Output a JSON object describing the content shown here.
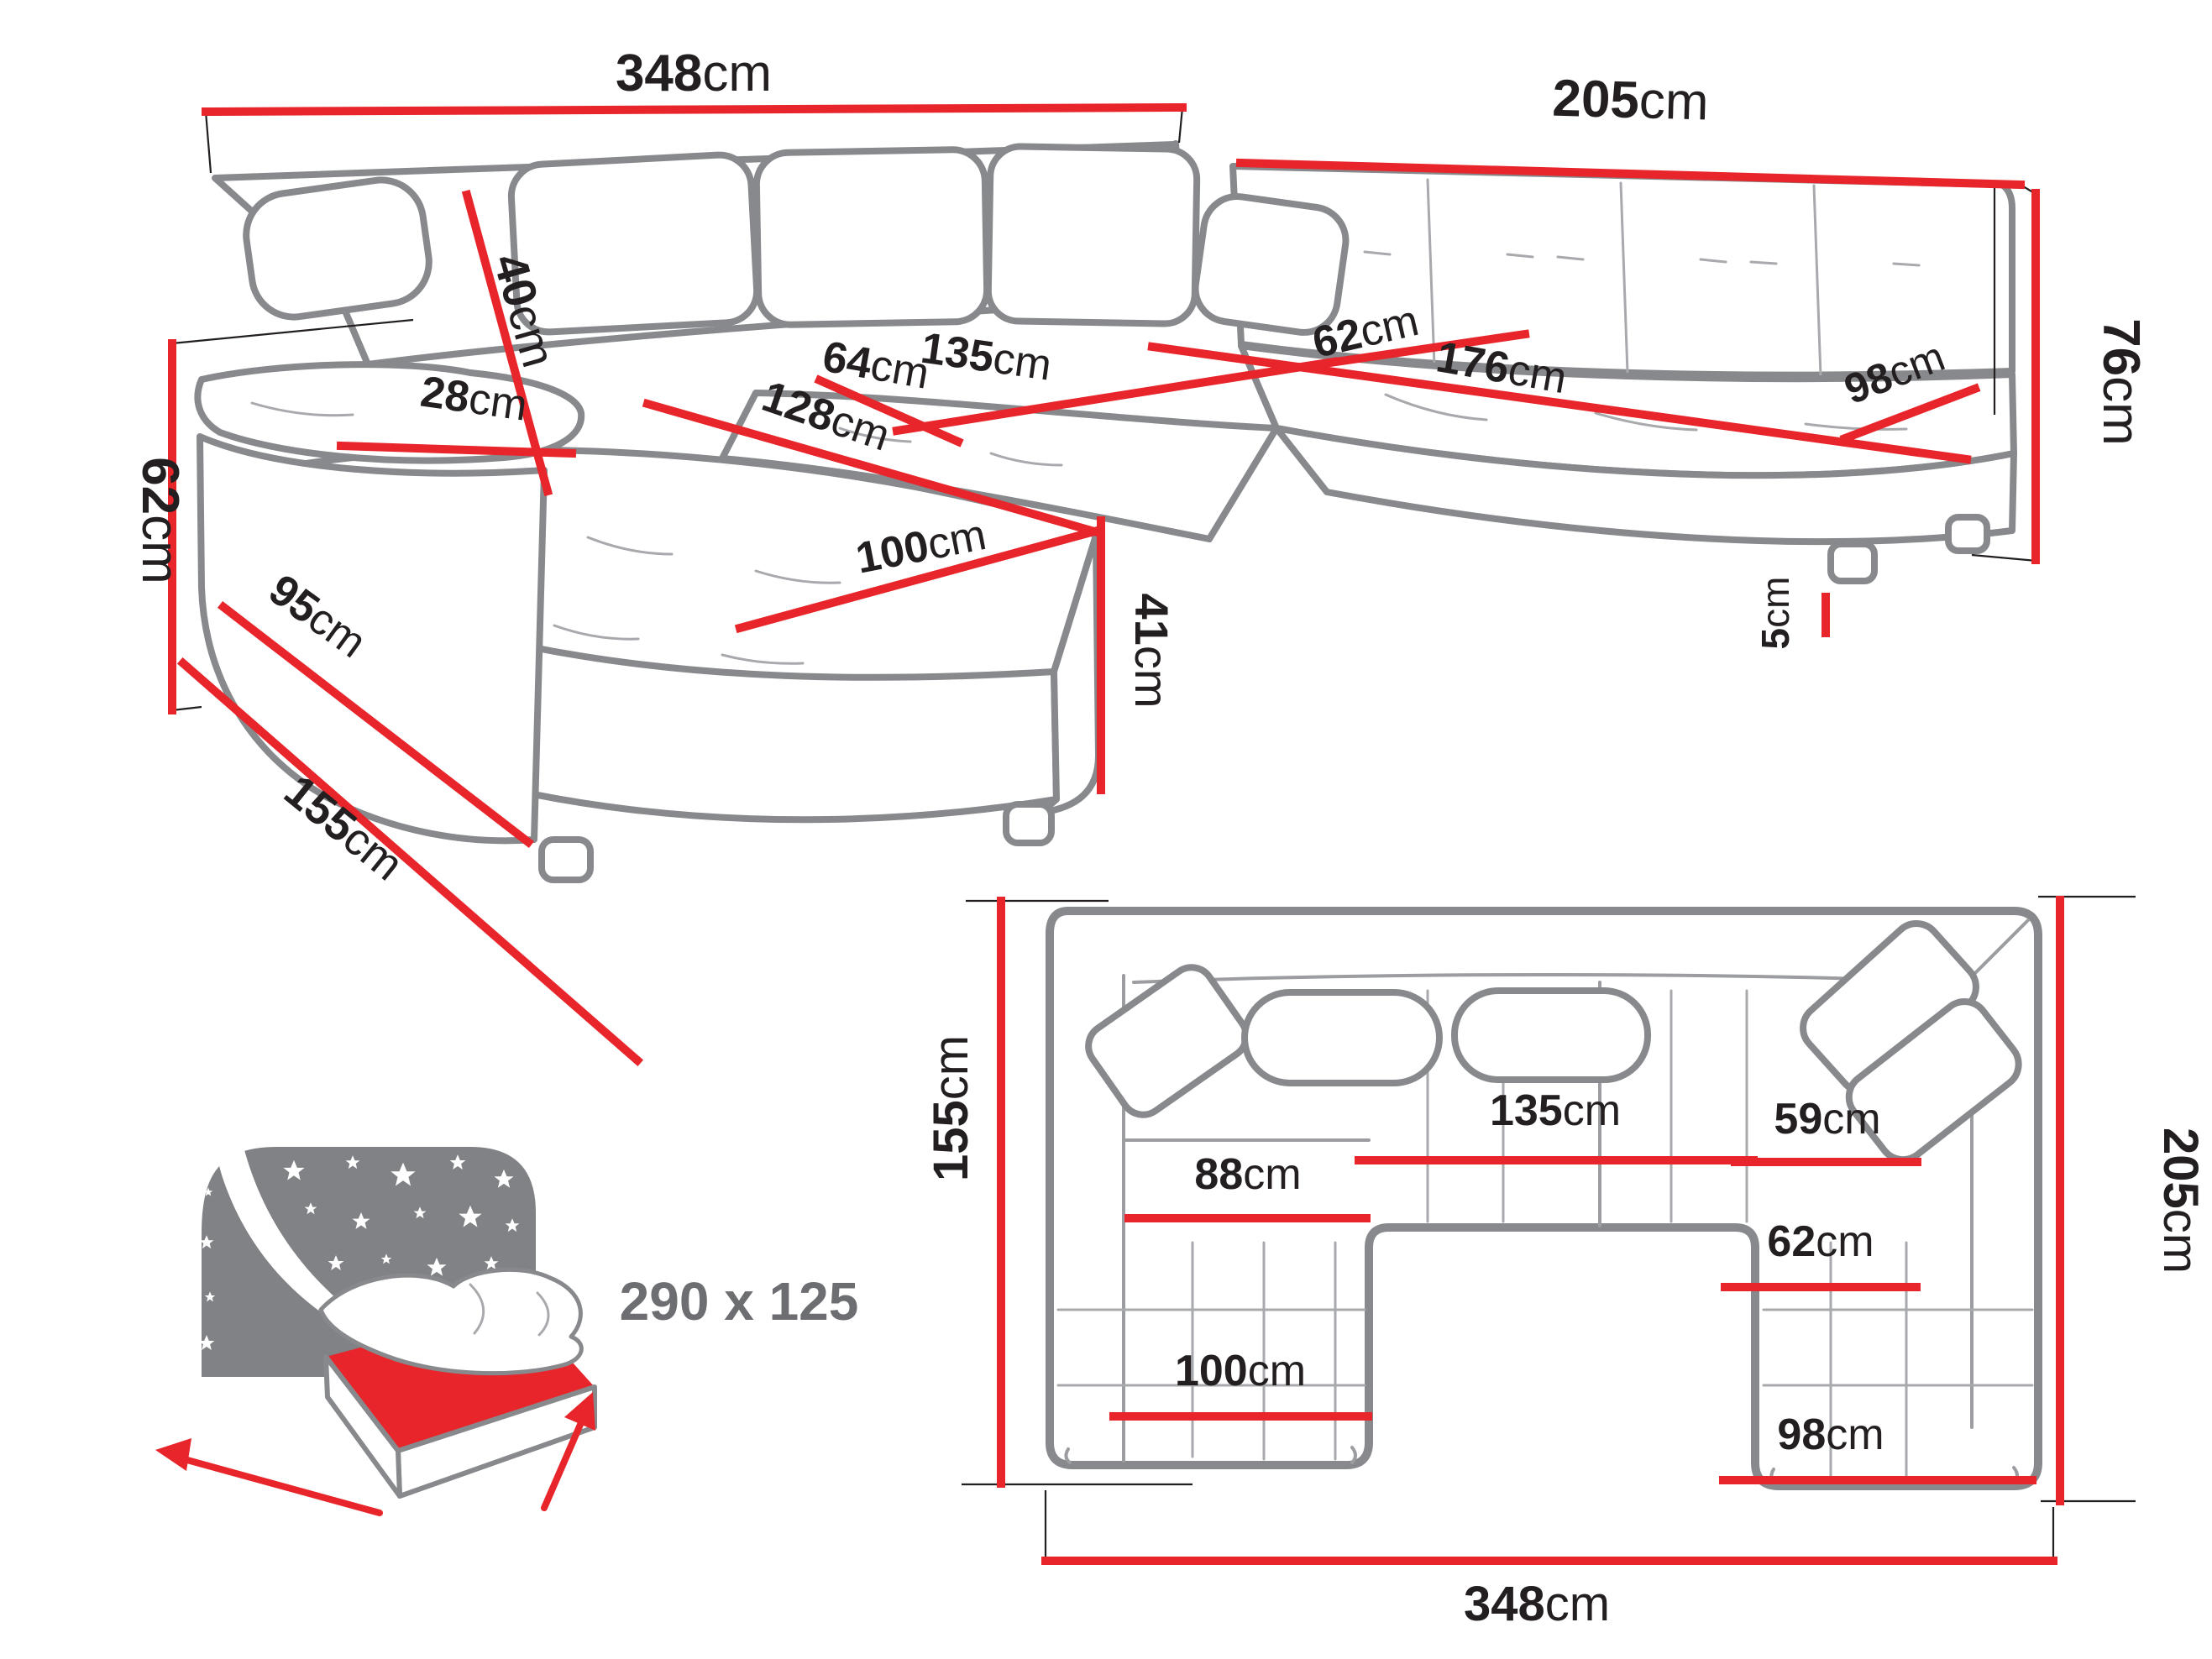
{
  "colors": {
    "accent_red": "#e8252a",
    "line_gray": "#87898c",
    "text_dark": "#231f20",
    "icon_gray": "#808285",
    "sleep_label_gray": "#6d6e71"
  },
  "perspective_view": {
    "dimensions": {
      "width_total": {
        "v": "348",
        "u": "cm"
      },
      "width_right": {
        "v": "205",
        "u": "cm"
      },
      "height_total": {
        "v": "76",
        "u": "cm"
      },
      "side_height": {
        "v": "62",
        "u": "cm"
      },
      "armrest_width": {
        "v": "28",
        "u": "cm"
      },
      "armrest_length": {
        "v": "95",
        "u": "cm"
      },
      "backrest_cushion": {
        "v": "40",
        "u": "cm"
      },
      "seat_depth": {
        "v": "64",
        "u": "cm"
      },
      "seat_width_center": {
        "v": "135",
        "u": "cm"
      },
      "chaise_length": {
        "v": "128",
        "u": "cm"
      },
      "chaise_width": {
        "v": "100",
        "u": "cm"
      },
      "seat_height": {
        "v": "41",
        "u": "cm"
      },
      "seat_depth_right": {
        "v": "62",
        "u": "cm"
      },
      "seat_width_right": {
        "v": "176",
        "u": "cm"
      },
      "seat_width_end": {
        "v": "98",
        "u": "cm"
      },
      "leg_height": {
        "v": "5",
        "u": "cm"
      },
      "chaise_depth": {
        "v": "155",
        "u": "cm"
      }
    }
  },
  "plan_view": {
    "dimensions": {
      "depth_left": {
        "v": "155",
        "u": "cm"
      },
      "depth_right": {
        "v": "205",
        "u": "cm"
      },
      "width_total": {
        "v": "348",
        "u": "cm"
      },
      "seat_width_center": {
        "v": "135",
        "u": "cm"
      },
      "chaise_inner_width": {
        "v": "88",
        "u": "cm"
      },
      "seat_depth_top_right": {
        "v": "59",
        "u": "cm"
      },
      "seat_depth_right": {
        "v": "62",
        "u": "cm"
      },
      "chaise_width": {
        "v": "100",
        "u": "cm"
      },
      "seat_width_bottom": {
        "v": "98",
        "u": "cm"
      }
    }
  },
  "sleeping_area": {
    "label": "290 x 125"
  }
}
